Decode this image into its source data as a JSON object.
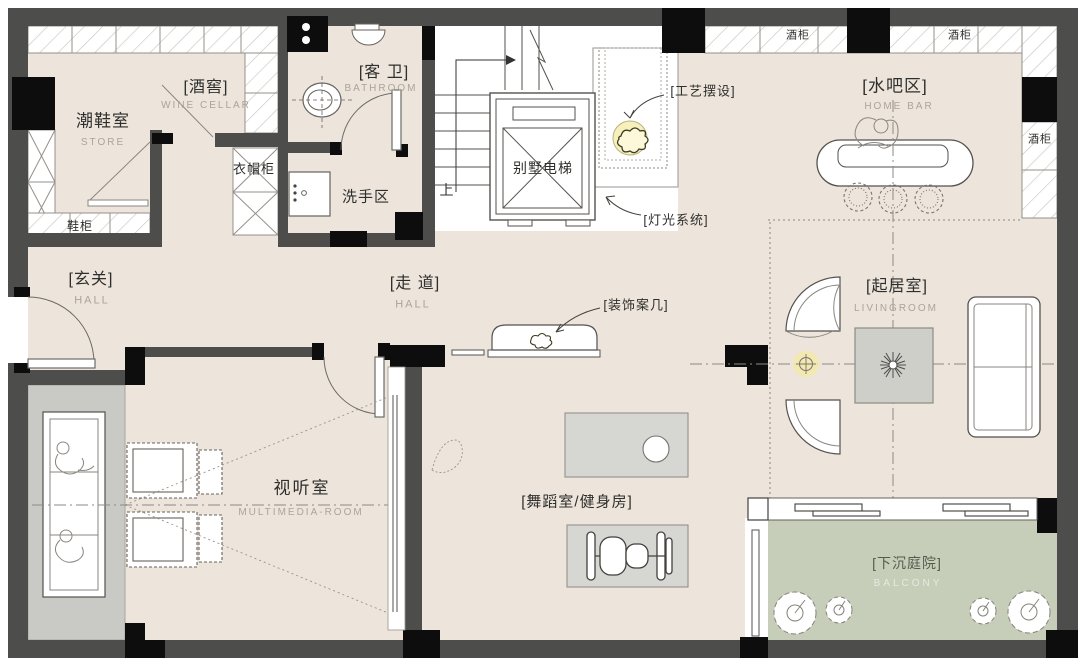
{
  "rooms": {
    "store": {
      "name_cn": "潮鞋室",
      "name_en": "STORE"
    },
    "wine_cellar": {
      "name_cn": "[酒窖]",
      "name_en": "WINE CELLAR"
    },
    "bathroom": {
      "name_cn": "[客 卫]",
      "name_en": "BATHROOM"
    },
    "wash_area": {
      "name_cn": "洗手区"
    },
    "entry": {
      "name_cn": "[玄关]",
      "name_en": "HALL"
    },
    "corridor": {
      "name_cn": "[走 道]",
      "name_en": "HALL"
    },
    "multimedia": {
      "name_cn": "视听室",
      "name_en": "MULTIMEDIA-ROOM"
    },
    "gym": {
      "name_cn": "[舞蹈室/健身房]"
    },
    "living": {
      "name_cn": "[起居室]",
      "name_en": "LIVINGROOM"
    },
    "bar": {
      "name_cn": "[水吧区]",
      "name_en": "HOME BAR"
    },
    "courtyard": {
      "name_cn": "[下沉庭院]",
      "name_en": "BALCONY"
    },
    "elevator": {
      "name_cn": "别墅电梯"
    }
  },
  "cabinets": {
    "wardrobe": "衣帽柜",
    "shoe_cabinet": "鞋柜",
    "wine_cabinet_top_left": "酒柜",
    "wine_cabinet_top_right": "酒柜",
    "wine_cabinet_right": "酒柜"
  },
  "annotations": {
    "craft_display": "[工艺摆设]",
    "lighting_system": "[灯光系统]",
    "console_table": "[装饰案几]",
    "stairs_up": "上"
  },
  "colors": {
    "wall": "#4d4d4b",
    "column": "#0d0d0d",
    "floor": "#ede5dc",
    "courtyard_green": "#c6cdb9",
    "media_floor_grey": "#c9c9c6",
    "mat_grey": "#d6d6d2",
    "highlight_yellow": "#f3e9a8"
  }
}
